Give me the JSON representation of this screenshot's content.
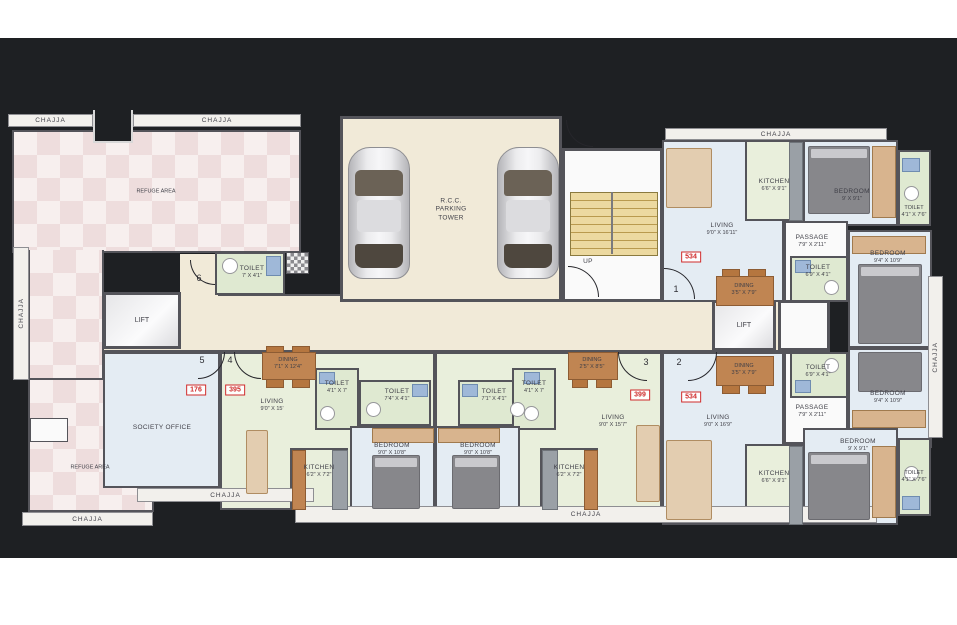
{
  "labels": {
    "chajja": "CHAJJA",
    "refuge_area": "REFUGE AREA",
    "lift": "LIFT",
    "society_office": "SOCIETY OFFICE",
    "up": "UP",
    "parking_lines": [
      "R.C.C.",
      "PARKING",
      "TOWER"
    ]
  },
  "units": {
    "society_office": "176",
    "flat_395": "395",
    "flat_399": "399",
    "flat_534_top": "534",
    "flat_534_bottom": "534"
  },
  "doors": {
    "d1": "1",
    "d2": "2",
    "d3": "3",
    "d4": "4",
    "d5": "5",
    "d6": "6"
  },
  "rooms": {
    "hall_toilet": {
      "name": "TOILET",
      "dims": "7' X 4'1\""
    },
    "flat_395": {
      "living": {
        "name": "LIVING",
        "dims": "9'0\" X 15'"
      },
      "dining": {
        "name": "DINING",
        "dims": "7'1\" X 12'4\""
      },
      "toilet_small": {
        "name": "TOILET",
        "dims": "4'1\" X 7'"
      },
      "toilet_wide": {
        "name": "TOILET",
        "dims": "7'4\" X 4'1\""
      },
      "bedroom": {
        "name": "BEDROOM",
        "dims": "9'0\" X 10'8\""
      },
      "kitchen": {
        "name": "KITCHEN",
        "dims": "6'2\" X 7'2\""
      }
    },
    "flat_399": {
      "living": {
        "name": "LIVING",
        "dims": "9'0\" X 15'7\""
      },
      "dining": {
        "name": "DINING",
        "dims": "2'5\" X 8'5\""
      },
      "toilet_wide": {
        "name": "TOILET",
        "dims": "7'1\" X 4'1\""
      },
      "toilet_small": {
        "name": "TOILET",
        "dims": "4'1\" X 7'"
      },
      "bedroom": {
        "name": "BEDROOM",
        "dims": "9'0\" X 10'8\""
      },
      "kitchen": {
        "name": "KITCHEN",
        "dims": "6'2\" X 7'2\""
      }
    },
    "flat_534_top": {
      "living": {
        "name": "LIVING",
        "dims": "9'0\" X 16'11\""
      },
      "kitchen": {
        "name": "KITCHEN",
        "dims": "6'6\" X 9'1\""
      },
      "bedroom_small": {
        "name": "BEDROOM",
        "dims": "9' X 9'1\""
      },
      "toilet_corner": {
        "name": "TOILET",
        "dims": "4'1\" X 7'6\""
      },
      "passage": {
        "name": "PASSAGE",
        "dims": "7'9\" X 2'11\""
      },
      "toilet_mid": {
        "name": "TOILET",
        "dims": "6'9\" X 4'1\""
      },
      "bedroom_big": {
        "name": "BEDROOM",
        "dims": "9'4\" X 10'9\""
      },
      "dining": {
        "name": "DINING",
        "dims": "3'5\" X 7'9\""
      }
    },
    "flat_534_bottom": {
      "living": {
        "name": "LIVING",
        "dims": "9'0\" X 16'9\""
      },
      "kitchen": {
        "name": "KITCHEN",
        "dims": "6'6\" X 9'1\""
      },
      "bedroom_small": {
        "name": "BEDROOM",
        "dims": "9' X 9'1\""
      },
      "toilet_corner": {
        "name": "TOILET",
        "dims": "4'1\" X 7'6\""
      },
      "passage": {
        "name": "PASSAGE",
        "dims": "7'9\" X 2'11\""
      },
      "toilet_mid": {
        "name": "TOILET",
        "dims": "6'9\" X 4'1\""
      },
      "bedroom_big": {
        "name": "BEDROOM",
        "dims": "9'4\" X 10'9\""
      },
      "dining": {
        "name": "DINING",
        "dims": "3'5\" X 7'9\""
      }
    }
  },
  "colors": {
    "background": "#1e2023",
    "wall": "#54545a",
    "unit_number_red": "#cf2b2b",
    "refuge_pink": "#f0dede",
    "corridor_cream": "#f1ead8"
  }
}
